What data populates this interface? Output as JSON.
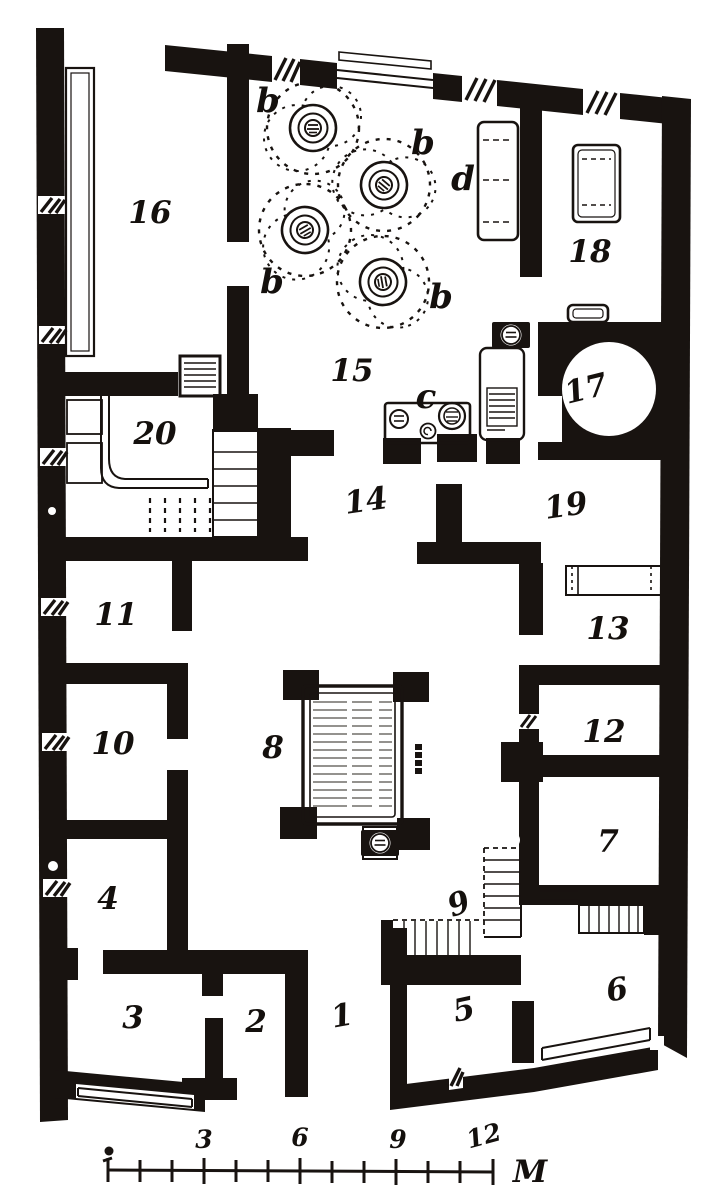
{
  "figure": {
    "kind": "engraved floor plan of a Roman house",
    "colors": {
      "ink": "#181310",
      "paper": "#ffffff"
    }
  },
  "rooms": [
    {
      "number": "1"
    },
    {
      "number": "2"
    },
    {
      "number": "3"
    },
    {
      "number": "4"
    },
    {
      "number": "5"
    },
    {
      "number": "6"
    },
    {
      "number": "7"
    },
    {
      "number": "8"
    },
    {
      "number": "9"
    },
    {
      "number": "10"
    },
    {
      "number": "11"
    },
    {
      "number": "12"
    },
    {
      "number": "13"
    },
    {
      "number": "14"
    },
    {
      "number": "15"
    },
    {
      "number": "16"
    },
    {
      "number": "17"
    },
    {
      "number": "18"
    },
    {
      "number": "19"
    },
    {
      "number": "20"
    }
  ],
  "letters": {
    "b": "b",
    "c": "c",
    "d": "d"
  },
  "scale_bar": {
    "tick_labels": [
      "3",
      "6",
      "9",
      "12"
    ],
    "unit_label": "M",
    "num_divisions": 12
  }
}
